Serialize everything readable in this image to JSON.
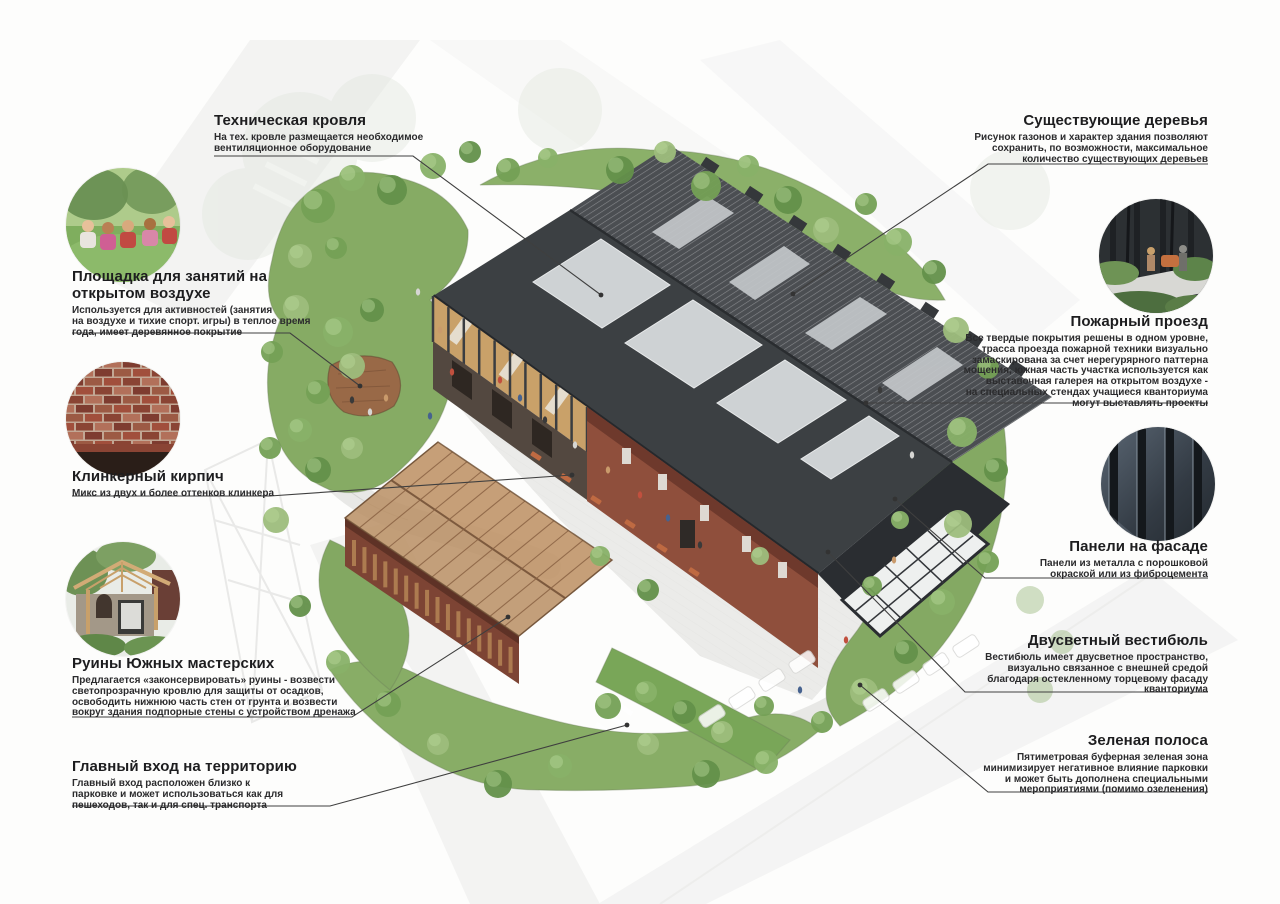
{
  "board_type": "site plan annotation board",
  "colors": {
    "roof_dark": "#3c4043",
    "roof_far": "#4b4e52",
    "roof_light_panel": "#ced2d4",
    "brick": "#8f4f3c",
    "timber": "#c9a169",
    "ruins_roof": "#b98e63",
    "greenery": "#86ab64",
    "green_buffer": "#79a658",
    "paving": "#e9e9e7",
    "glazing": "#eef0ef",
    "leader_line": "#3f3f3f",
    "text": "#1d1d1f"
  },
  "photos": {
    "outdoor_area": "children at an outdoor lesson on a lawn",
    "clinker_brick": "clinker brick wall texture",
    "ruins": "preserved ruins with translucent timber roof",
    "trees_near_facade": "people and trees near a dark facade",
    "facade_panels": "dark ribbed metal facade panels"
  },
  "annotations": {
    "tech_roof": {
      "title": "Техническая кровля",
      "body": "На тех. кровле размещается необходимое\nвентиляционное оборудование"
    },
    "existing_trees": {
      "title": "Существующие деревья",
      "body": "Рисунок газонов и характер здания позволяют\nсохранить, по возможности, максимальное\nколичество существующих деревьев"
    },
    "outdoor_area": {
      "title": "Площадка для занятий на\nоткрытом воздухе",
      "body": "Используется для активностей (занятия\nна воздухе и тихие спорт. игры) в теплое время\nгода, имеет деревянное покрытие"
    },
    "clinker_brick": {
      "title": "Клинкерный кирпич",
      "body": "Микс из двух и более оттенков клинкера"
    },
    "ruins": {
      "title": "Руины Южных мастерских",
      "body": "Предлагается «законсервировать» руины - возвести\nсветопрозрачную кровлю для защиты от осадков,\nосвободить нижнюю часть стен от грунта и возвести\nвокруг здания подпорные стены с устройством дренажа"
    },
    "main_entrance": {
      "title": "Главный вход на территорию",
      "body": "Главный вход расположен близко к\nпарковке и может использоваться как для\nпешеходов, так и для спец. транспорта"
    },
    "fire_lane": {
      "title": "Пожарный проезд",
      "body": "Все твердые покрытия решены в одном уровне,\nтрасса проезда пожарной техники визуально\nзамаскирована за счет нерегурярного паттерна\nмощения, южная часть участка используется как\nвыставочная галерея на открытом воздухе -\nна специальных стендах учащиеся кванториума\nмогут выставлять проекты"
    },
    "facade_panels": {
      "title": "Панели на фасаде",
      "body": "Панели из металла с порошковой\nокраской или из фиброцемента"
    },
    "vestibule": {
      "title": "Двусветный вестибюль",
      "body": "Вестибюль имеет двусветное пространство,\nвизуально связанное с внешней средой\nблагодаря остекленному торцевому фасаду\nкванториума"
    },
    "green_strip": {
      "title": "Зеленая полоса",
      "body": "Пятиметровая буферная зеленая зона\nминимизирует негативное влияние парковки\nи может быть дополнена специальными\nмероприятиями (помимо озеленения)"
    }
  }
}
